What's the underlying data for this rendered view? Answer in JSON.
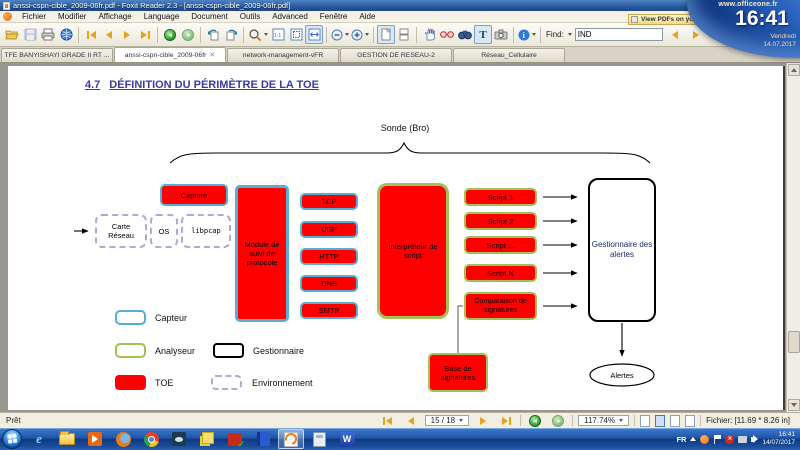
{
  "titlebar": {
    "title": "anssi-cspn-cible_2009-06fr.pdf - Foxit Reader 2.3 - [anssi-cspn-cible_2009-06fr.pdf]"
  },
  "menubar": {
    "items": [
      "Fichier",
      "Modifier",
      "Affichage",
      "Language",
      "Document",
      "Outils",
      "Advanced",
      "Fenêtre",
      "Aide"
    ]
  },
  "toolbar": {
    "find_label": "Find:",
    "find_value": "IND",
    "notification": "View PDFs on your m..."
  },
  "tabbar": {
    "tabs": [
      "TFE BANYISHAYI GRADE II RT ...",
      "anssi-cspn-cible_2009-06fr",
      "network-management-vFR",
      "GESTION DE RESEAU-2",
      "Réseau_Cellulaire"
    ],
    "active_index": 1,
    "close_glyph": "✕"
  },
  "document": {
    "heading_number": "4.7",
    "heading_title": "DÉFINITION DU PÉRIMÈTRE DE LA TOE",
    "diagram": {
      "sonde_label": "Sonde (Bro)",
      "capture": "Capture",
      "environment_boxes": [
        "Carte Réseau",
        "OS",
        "libpcap"
      ],
      "module": "Module de suivi de protocole",
      "protocols": [
        "TCP",
        "UDP",
        "HTTP",
        "DNS",
        "SMTP"
      ],
      "interpreter": "Interpréteur de script",
      "scripts": [
        "Script 1",
        "Script 2",
        "Script ...",
        "Script N"
      ],
      "comparison": "Comparaison de signatures",
      "manager": "Gestionnaire des alertes",
      "signature_base": "Base de signatures",
      "alerts": "Alertes",
      "legend": [
        {
          "label": "Capteur"
        },
        {
          "label": "Analyseur"
        },
        {
          "label": "Gestionnaire"
        },
        {
          "label": "TOE"
        },
        {
          "label": "Environnement"
        }
      ]
    }
  },
  "statusbar": {
    "ready": "Prêt",
    "page": "15 / 18",
    "zoom": "117.74%",
    "file_info": "Fichier: [11.69 * 8.26 in]"
  },
  "taskbar": {
    "language": "FR",
    "time": "16:41",
    "date": "14/07/2017"
  },
  "overlay": {
    "site": "www.officeone.fr",
    "time": "16:41",
    "day": "Vendredi",
    "date": "14.07.2017"
  },
  "colors": {
    "toe_red": "#fe0000",
    "capteur_blue": "#57aed2",
    "analyseur_green": "#a2c155",
    "environnement_purple": "#b6a6d8",
    "gestionnaire_black": "#000000"
  }
}
